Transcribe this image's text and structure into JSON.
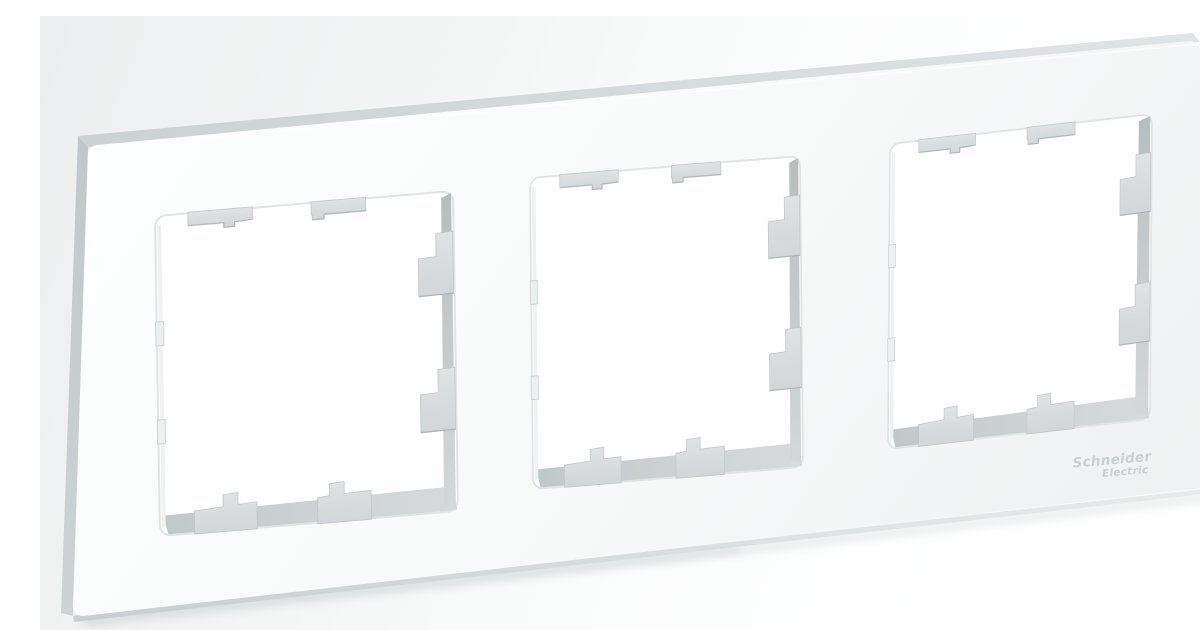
{
  "scene": {
    "alt": "Angled product photo of a white triple (3-post) wall frame for switches and sockets on a light studio background",
    "background": {
      "top_left": "#eceeef",
      "bottom_right": "#ffffff"
    }
  },
  "product": {
    "logo": {
      "line1": "Schneider",
      "line2": "Electric"
    },
    "logo_color": "#c3c8ca",
    "frame": {
      "face_color": "#f8fafa",
      "side_color": "#c9ced0",
      "top_bevel_color": "#d6dadb",
      "edge_highlight": "#ffffff"
    },
    "windows": {
      "count": 3,
      "hole_color": "#ffffff",
      "inner_right_face_color": "#bac0c2",
      "inner_bottom_face_color": "#c6cbcd",
      "tab_color": "#dbdee0",
      "tab_edge_color": "#a9b0b2",
      "tabs_per_window": 8
    }
  }
}
